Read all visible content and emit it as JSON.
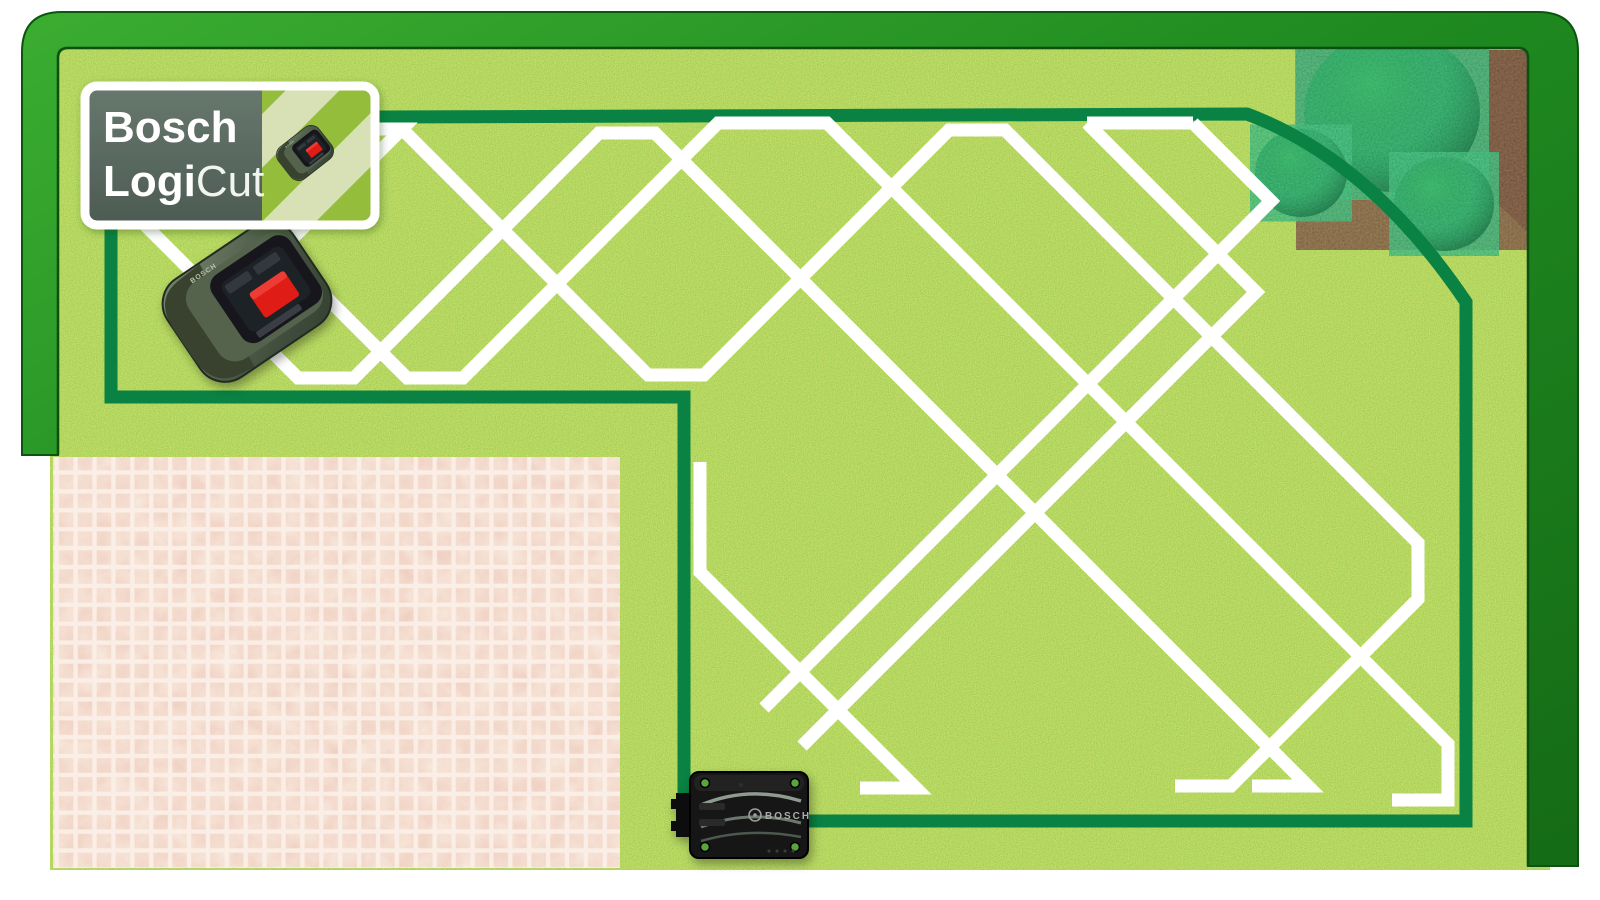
{
  "badge": {
    "brand": "Bosch",
    "product_bold": "Logi",
    "product_light": "Cut"
  },
  "charging_station": {
    "label": "BOSCH"
  },
  "robot_mower": {
    "label": "BOSCH"
  },
  "colors": {
    "page_background": "#ffffff",
    "frame_green_light": "#3bad31",
    "frame_green_dark": "#156b16",
    "grass_mid": "#62ae28",
    "boundary_wire": "#098243",
    "mow_line": "#ffffff",
    "patio_tile": "#f2c0ab",
    "patio_grout": "#fbf1ea",
    "mulch_brown": "#3a2416",
    "bush_green": "#0d7c3e",
    "badge_panel_gray": "#5a6a61",
    "badge_stripe_pale": "#d8e0b6",
    "badge_stripe_green": "#94bd3a",
    "mower_body": "#4d5c49",
    "mower_button_red": "#df1b16",
    "station_black": "#131313"
  },
  "scene": {
    "boundary_wire_d": "M111,397 L111,118 L1247,114 Q1370,160 1466,302 L1466,821 L684,821 L684,397 Z",
    "flowerbed_d": "M1296,50 L1545,50 L1545,250 Q1408,112 1296,50 Z",
    "wire_arc_note": "boundary curves around corner flower bed",
    "bushes": [
      {
        "cx": 1392,
        "cy": 112,
        "rx": 88,
        "ry": 80
      },
      {
        "cx": 1301,
        "cy": 173,
        "rx": 46,
        "ry": 44
      },
      {
        "cx": 1444,
        "cy": 204,
        "rx": 50,
        "ry": 47
      }
    ],
    "mow_path_segments": [
      [
        [
          352,
          129
        ],
        [
          402,
          129
        ],
        [
          233,
          298
        ]
      ],
      [
        [
          402,
          129
        ],
        [
          648,
          375
        ],
        [
          704,
          375
        ],
        [
          949,
          130
        ],
        [
          1005,
          130
        ],
        [
          1418,
          543
        ],
        [
          1418,
          599
        ],
        [
          1231,
          786
        ],
        [
          1175,
          786
        ]
      ],
      [
        [
          112,
          192
        ],
        [
          298,
          378
        ],
        [
          354,
          378
        ],
        [
          599,
          133
        ],
        [
          655,
          133
        ],
        [
          1308,
          786
        ],
        [
          1252,
          786
        ]
      ],
      [
        [
          229,
          200
        ],
        [
          407,
          378
        ],
        [
          463,
          378
        ],
        [
          718,
          123
        ],
        [
          827,
          123
        ],
        [
          1448,
          744
        ],
        [
          1448,
          800
        ],
        [
          1392,
          800
        ]
      ],
      [
        [
          1087,
          123
        ],
        [
          1193,
          123
        ]
      ],
      [
        [
          1087,
          123
        ],
        [
          1256,
          292
        ],
        [
          802,
          746
        ]
      ],
      [
        [
          1193,
          123
        ],
        [
          1271,
          201
        ],
        [
          764,
          708
        ]
      ],
      [
        [
          700,
          462
        ],
        [
          700,
          572
        ],
        [
          916,
          788
        ],
        [
          860,
          788
        ]
      ]
    ],
    "mow_line_width": 13,
    "wire_width": 13
  }
}
